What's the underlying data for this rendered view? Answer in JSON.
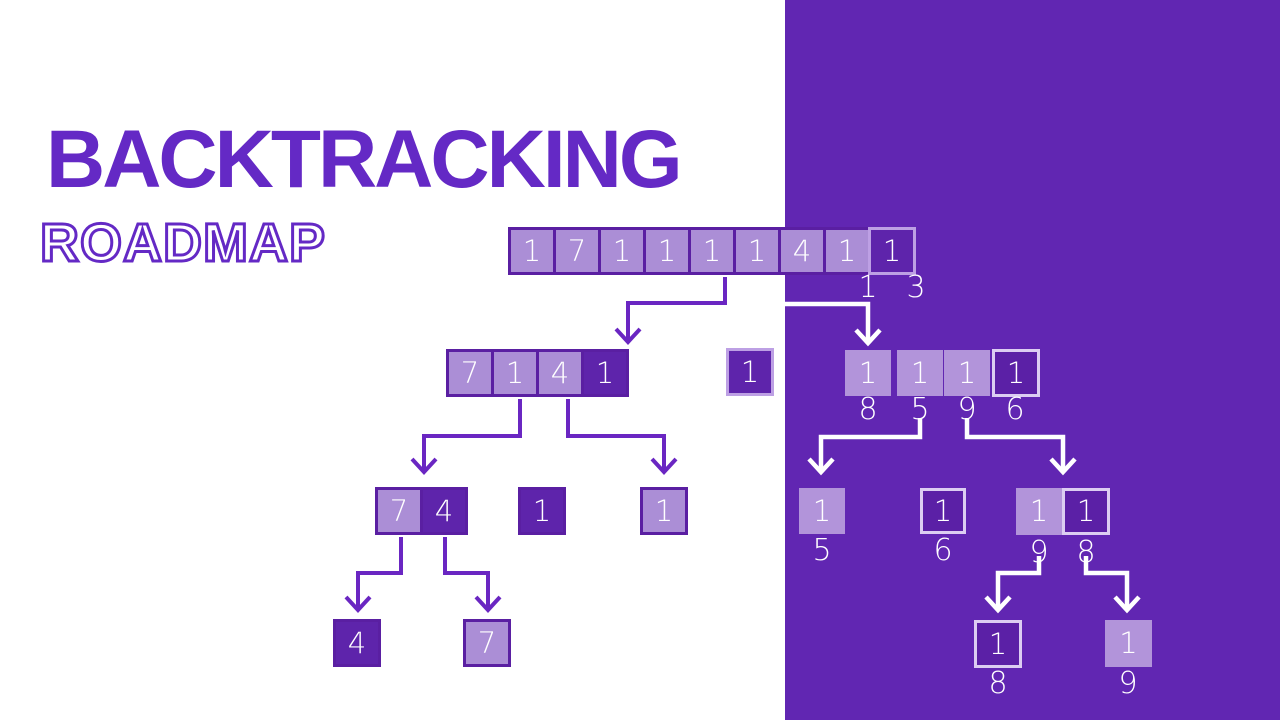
{
  "title": "BACKTRACKING",
  "subtitle": "ROADMAP",
  "colors": {
    "panel": "#6126b2",
    "title_text": "#6429c5",
    "subtitle_outline": "#6429c5",
    "light_box_fill": "#ab8ed6",
    "dark_box_fill": "#5e24ab",
    "panel_dark_box_fill": "#5b20a6",
    "panel_light_box_fill": "#b294da",
    "dark_border": "#5a1fa2",
    "light_border": "#bda0e4",
    "pale_border": "#dccdf2",
    "line_purple": "#6a26c2",
    "line_white": "#ffffff",
    "box_text": "#ffffff"
  },
  "tree": {
    "boxes": [
      {
        "name": "root-row",
        "x": 508,
        "y": 227,
        "cells": [
          {
            "t": "1",
            "v": "light",
            "w": 48,
            "h": 48
          },
          {
            "t": "7",
            "v": "light",
            "w": 48,
            "h": 48
          },
          {
            "t": "1",
            "v": "light",
            "w": 48,
            "h": 48
          },
          {
            "t": "1",
            "v": "light",
            "w": 48,
            "h": 48
          },
          {
            "t": "1",
            "v": "light",
            "w": 48,
            "h": 48
          },
          {
            "t": "1",
            "v": "light",
            "w": 48,
            "h": 48
          },
          {
            "t": "4",
            "v": "light",
            "w": 48,
            "h": 48
          },
          {
            "t": "1",
            "v": "light",
            "w": 48,
            "h": 48
          },
          {
            "t": "1",
            "v": "darkLight",
            "w": 48,
            "h": 48
          }
        ]
      },
      {
        "name": "level2-left-row",
        "x": 446,
        "y": 349,
        "cells": [
          {
            "t": "7",
            "v": "light",
            "w": 48,
            "h": 48
          },
          {
            "t": "1",
            "v": "light",
            "w": 48,
            "h": 48
          },
          {
            "t": "4",
            "v": "light",
            "w": 48,
            "h": 48
          },
          {
            "t": "1",
            "v": "dark",
            "w": 48,
            "h": 48
          }
        ]
      },
      {
        "name": "level2-left-single",
        "x": 726,
        "y": 348,
        "cells": [
          {
            "t": "1",
            "v": "darkLight",
            "w": 48,
            "h": 48
          }
        ]
      },
      {
        "name": "level2-right-box-1",
        "x": 845,
        "y": 350,
        "cells": [
          {
            "t": "1",
            "v": "panelLight",
            "w": 46,
            "h": 46
          }
        ]
      },
      {
        "name": "level2-right-box-2",
        "x": 897,
        "y": 350,
        "cells": [
          {
            "t": "1",
            "v": "panelLight",
            "w": 46,
            "h": 46
          }
        ]
      },
      {
        "name": "level2-right-box-3",
        "x": 944,
        "y": 350,
        "cells": [
          {
            "t": "1",
            "v": "panelLight",
            "w": 46,
            "h": 46
          }
        ]
      },
      {
        "name": "level2-right-box-4",
        "x": 992,
        "y": 349,
        "cells": [
          {
            "t": "1",
            "v": "panelDark",
            "w": 48,
            "h": 48
          }
        ]
      },
      {
        "name": "level3-left-pair",
        "x": 375,
        "y": 487,
        "cells": [
          {
            "t": "7",
            "v": "light",
            "w": 48,
            "h": 48
          },
          {
            "t": "4",
            "v": "dark",
            "w": 48,
            "h": 48
          }
        ]
      },
      {
        "name": "level3-left-dark",
        "x": 518,
        "y": 487,
        "cells": [
          {
            "t": "1",
            "v": "dark",
            "w": 48,
            "h": 48
          }
        ]
      },
      {
        "name": "level3-left-light",
        "x": 640,
        "y": 487,
        "cells": [
          {
            "t": "1",
            "v": "light",
            "w": 48,
            "h": 48
          }
        ]
      },
      {
        "name": "level3-right-box-5",
        "x": 799,
        "y": 488,
        "cells": [
          {
            "t": "1",
            "v": "panelLight",
            "w": 46,
            "h": 46
          }
        ]
      },
      {
        "name": "level3-right-box-6",
        "x": 920,
        "y": 488,
        "cells": [
          {
            "t": "1",
            "v": "panelDark",
            "w": 46,
            "h": 46
          }
        ]
      },
      {
        "name": "level3-right-pair",
        "x": 1016,
        "y": 488,
        "cells": [
          {
            "t": "1",
            "v": "panelLight",
            "w": 46,
            "h": 47
          },
          {
            "t": "1",
            "v": "panelDark",
            "w": 48,
            "h": 47
          }
        ]
      },
      {
        "name": "level4-left-dark",
        "x": 333,
        "y": 619,
        "cells": [
          {
            "t": "4",
            "v": "dark",
            "w": 48,
            "h": 48
          }
        ]
      },
      {
        "name": "level4-left-light",
        "x": 463,
        "y": 619,
        "cells": [
          {
            "t": "7",
            "v": "light",
            "w": 48,
            "h": 48
          }
        ]
      },
      {
        "name": "level4-right-dark",
        "x": 974,
        "y": 620,
        "cells": [
          {
            "t": "1",
            "v": "panelDark",
            "w": 48,
            "h": 48
          }
        ]
      },
      {
        "name": "level4-right-light",
        "x": 1105,
        "y": 620,
        "cells": [
          {
            "t": "1",
            "v": "panelLight",
            "w": 47,
            "h": 47
          }
        ]
      }
    ],
    "labels": [
      {
        "t": "1",
        "x": 868,
        "y": 288
      },
      {
        "t": "3",
        "x": 916,
        "y": 288
      },
      {
        "t": "8",
        "x": 868,
        "y": 410
      },
      {
        "t": "5",
        "x": 920,
        "y": 410
      },
      {
        "t": "9",
        "x": 967,
        "y": 410
      },
      {
        "t": "6",
        "x": 1015,
        "y": 410
      },
      {
        "t": "5",
        "x": 822,
        "y": 551
      },
      {
        "t": "6",
        "x": 943,
        "y": 551
      },
      {
        "t": "9",
        "x": 1039,
        "y": 553
      },
      {
        "t": "8",
        "x": 1086,
        "y": 553
      },
      {
        "t": "8",
        "x": 998,
        "y": 684
      },
      {
        "t": "9",
        "x": 1128,
        "y": 684
      }
    ],
    "arrows": [
      {
        "color": "purple",
        "pts": [
          [
            725,
            277
          ],
          [
            725,
            303
          ],
          [
            628,
            303
          ],
          [
            628,
            342
          ]
        ]
      },
      {
        "color": "white",
        "pts": [
          [
            785,
            304
          ],
          [
            868,
            304
          ],
          [
            868,
            343
          ]
        ]
      },
      {
        "color": "purple",
        "pts": [
          [
            520,
            399
          ],
          [
            520,
            436
          ],
          [
            424,
            436
          ],
          [
            424,
            472
          ]
        ]
      },
      {
        "color": "purple",
        "pts": [
          [
            568,
            399
          ],
          [
            568,
            436
          ],
          [
            664,
            436
          ],
          [
            664,
            472
          ]
        ]
      },
      {
        "color": "purple",
        "pts": [
          [
            401,
            537
          ],
          [
            401,
            573
          ],
          [
            358,
            573
          ],
          [
            358,
            610
          ]
        ]
      },
      {
        "color": "purple",
        "pts": [
          [
            445,
            537
          ],
          [
            445,
            573
          ],
          [
            488,
            573
          ],
          [
            488,
            610
          ]
        ]
      },
      {
        "color": "white",
        "pts": [
          [
            920,
            418
          ],
          [
            920,
            437
          ],
          [
            821,
            437
          ],
          [
            821,
            472
          ]
        ]
      },
      {
        "color": "white",
        "pts": [
          [
            967,
            418
          ],
          [
            967,
            437
          ],
          [
            1063,
            437
          ],
          [
            1063,
            472
          ]
        ]
      },
      {
        "color": "white",
        "pts": [
          [
            1039,
            556
          ],
          [
            1039,
            573
          ],
          [
            998,
            573
          ],
          [
            998,
            610
          ]
        ]
      },
      {
        "color": "white",
        "pts": [
          [
            1086,
            556
          ],
          [
            1086,
            573
          ],
          [
            1127,
            573
          ],
          [
            1127,
            610
          ]
        ]
      }
    ]
  }
}
